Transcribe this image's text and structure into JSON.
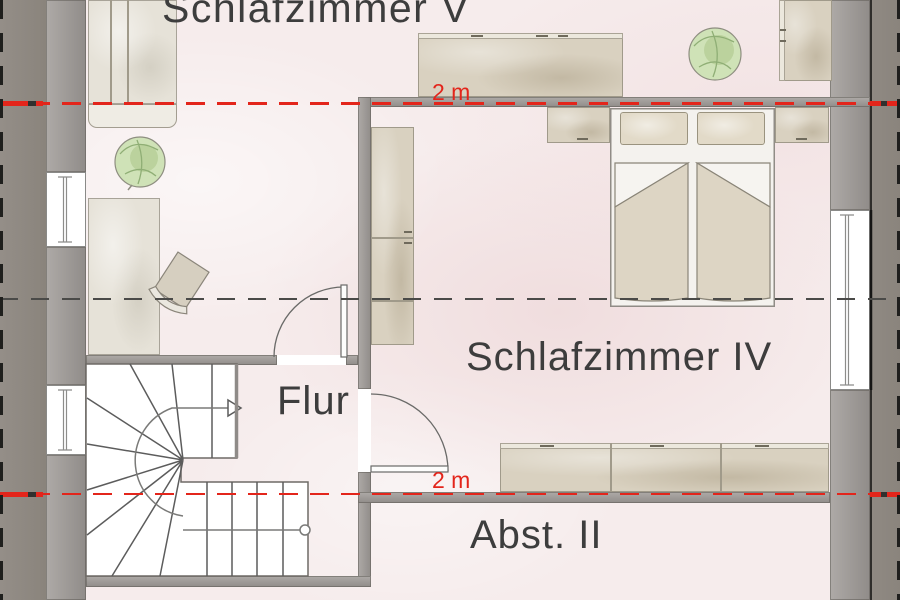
{
  "plan": {
    "type": "floor-plan",
    "rooms": [
      {
        "id": "schlafzimmer-v",
        "label": "Schlafzimmer V"
      },
      {
        "id": "schlafzimmer-iv",
        "label": "Schlafzimmer IV"
      },
      {
        "id": "flur",
        "label": "Flur"
      },
      {
        "id": "abst-ii",
        "label": "Abst. II"
      }
    ],
    "height_lines": {
      "top_label": "2 m",
      "bottom_label": "2 m"
    },
    "colors": {
      "floor": "#f6ecec",
      "wall": "#9b9794",
      "roof_margin": "#8d8781",
      "window": "#ffffff",
      "furniture": "#d9d1c0",
      "plant": "#cfe2b7",
      "height_line_red": "#e3251b",
      "center_line_black": "#4a4a48",
      "label_text": "#3d3d3d"
    }
  }
}
